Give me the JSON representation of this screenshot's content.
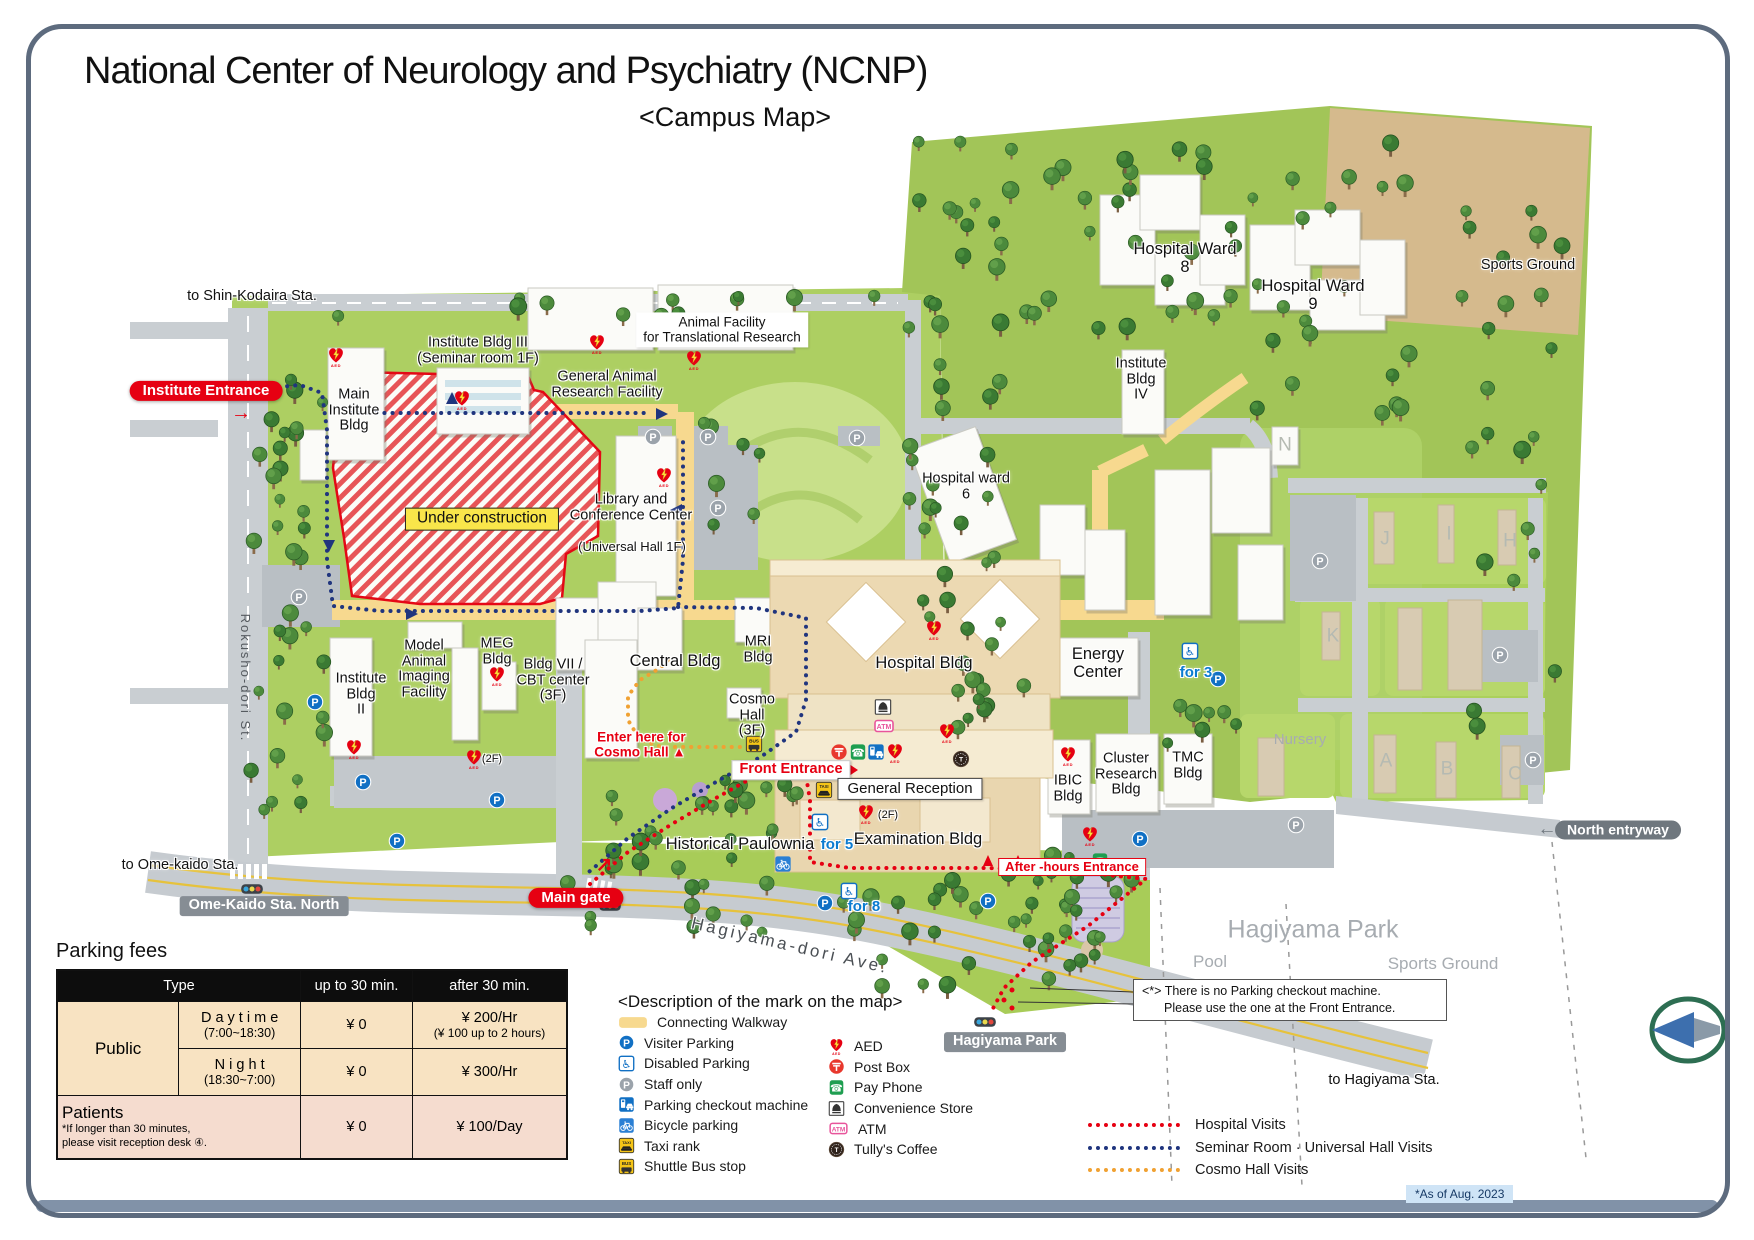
{
  "title": {
    "main": "National Center of Neurology and Psychiatry (NCNP)",
    "sub": "<Campus Map>"
  },
  "map": {
    "labels": {
      "to_shin_kodaira": "to Shin-Kodaira Sta.",
      "institute_entrance": "Institute Entrance",
      "inst_arrow": "→",
      "main_institute": "Main\nInstitute\nBldg",
      "institute_bldg3": "Institute Bldg III\n(Seminar room 1F)",
      "general_animal": "General Animal\nResearch Facility",
      "animal_facility": "Animal Facility\nfor Translational Research",
      "under_construction": "Under construction",
      "library": "Library and\nConference Center",
      "library_hall": "(Universal Hall 1F)",
      "rokusho_st": "Rokusho-dori St.",
      "to_ome_kaido": "to Ome-kaido Sta.",
      "ome_kaido_north": "Ome-Kaido Sta. North",
      "main_gate": "Main gate",
      "gate_arrow": "↗",
      "hagiyama_ave": "Hagiyama-dori Ave.",
      "hagiyama_park_sign": "Hagiyama Park",
      "model_animal": "Model\nAnimal\nImaging\nFacility",
      "meg": "MEG\nBldg",
      "bldg7": "Bldg VII /\nCBT center\n(3F)",
      "institute_bldg2": "Institute\nBldg\nII",
      "central": "Central Bldg",
      "mri": "MRI\nBldg",
      "cosmo": "Cosmo\nHall\n(3F)",
      "hospital_bldg": "Hospital Bldg",
      "energy": "Energy\nCenter",
      "hospital_ward6": "Hospital ward\n6",
      "hospital_ward8": "Hospital Ward\n8",
      "hospital_ward9": "Hospital Ward\n9",
      "institute_bldg4": "Institute\nBldg\nIV",
      "sports_ground_ne": "Sports Ground",
      "enter_cosmo": "Enter here for\nCosmo Hall ▲",
      "front_entrance": "Front Entrance",
      "general_reception": "General Reception",
      "examination": "Examination Bldg",
      "after_hours": "After -hours Entrance",
      "ibic": "IBIC\nBldg",
      "cluster": "Cluster\nResearch\nBldg",
      "tmc": "TMC\nBldg",
      "nursery": "Nursery",
      "historical_paulownia": "Historical Paulownia",
      "for3": "for 3",
      "for5": "for 5",
      "for8": "for 8",
      "bldg_n": "N",
      "bldg_j": "J",
      "bldg_i": "I",
      "bldg_h": "H",
      "bldg_k": "K",
      "bldg_a": "A",
      "bldg_b": "B",
      "bldg_c": "C",
      "north_entryway": "North entryway",
      "north_arrow": "←",
      "hagiyama_park_area": "Hagiyama Park",
      "pool": "Pool",
      "sports_ground_park": "Sports Ground",
      "to_hagiyama": "to Hagiyama Sta.",
      "aed_2f_a": "(2F)",
      "aed_2f_b": "(2F)"
    }
  },
  "legend": {
    "heading": "<Description of the mark on the map>",
    "left": [
      [
        "walkway",
        "Connecting Walkway"
      ],
      [
        "pblue",
        "Visiter Parking"
      ],
      [
        "disabled",
        "Disabled Parking"
      ],
      [
        "pgray",
        "Staff only"
      ],
      [
        "checkout",
        "Parking checkout machine"
      ],
      [
        "bicycle",
        "Bicycle parking"
      ],
      [
        "taxi",
        "Taxi rank"
      ],
      [
        "bus",
        "Shuttle Bus stop"
      ]
    ],
    "right": [
      [
        "aed",
        "AED"
      ],
      [
        "postbox",
        "Post Box"
      ],
      [
        "payphone",
        "Pay Phone"
      ],
      [
        "store",
        "Convenience Store"
      ],
      [
        "atm",
        "ATM"
      ],
      [
        "tullys",
        "Tully's Coffee"
      ]
    ]
  },
  "routes": [
    {
      "label": "Hospital Visits",
      "color": "#e60012"
    },
    {
      "label": "Seminar Room · Universal Hall  Visits",
      "color": "#20357e"
    },
    {
      "label": "Cosmo Hall Visits",
      "color": "#f0a132"
    }
  ],
  "parking": {
    "title": "Parking fees",
    "col_type": "Type",
    "col_upto": "up to 30 min.",
    "col_after": "after 30 min.",
    "public_label": "Public",
    "daytime": "D a y t i m e",
    "daytime_hours": "(7:00~18:30)",
    "daytime_upto": "¥ 0",
    "daytime_after": "¥ 200/Hr",
    "daytime_after_sub": "(¥ 100 up to 2 hours)",
    "night": "N i g h t",
    "night_hours": "(18:30~7:00)",
    "night_upto": "¥ 0",
    "night_after": "¥ 300/Hr",
    "patients_label": "Patients",
    "patients_note": "*If longer than 30 minutes,\nplease visit reception desk ④.",
    "patients_upto": "¥ 0",
    "patients_after": "¥ 100/Day"
  },
  "note": {
    "line1": "<*> There is no Parking checkout machine.",
    "line2": "Please use the one at the Front Entrance."
  },
  "footer": {
    "as_of": "*As of Aug. 2023"
  }
}
